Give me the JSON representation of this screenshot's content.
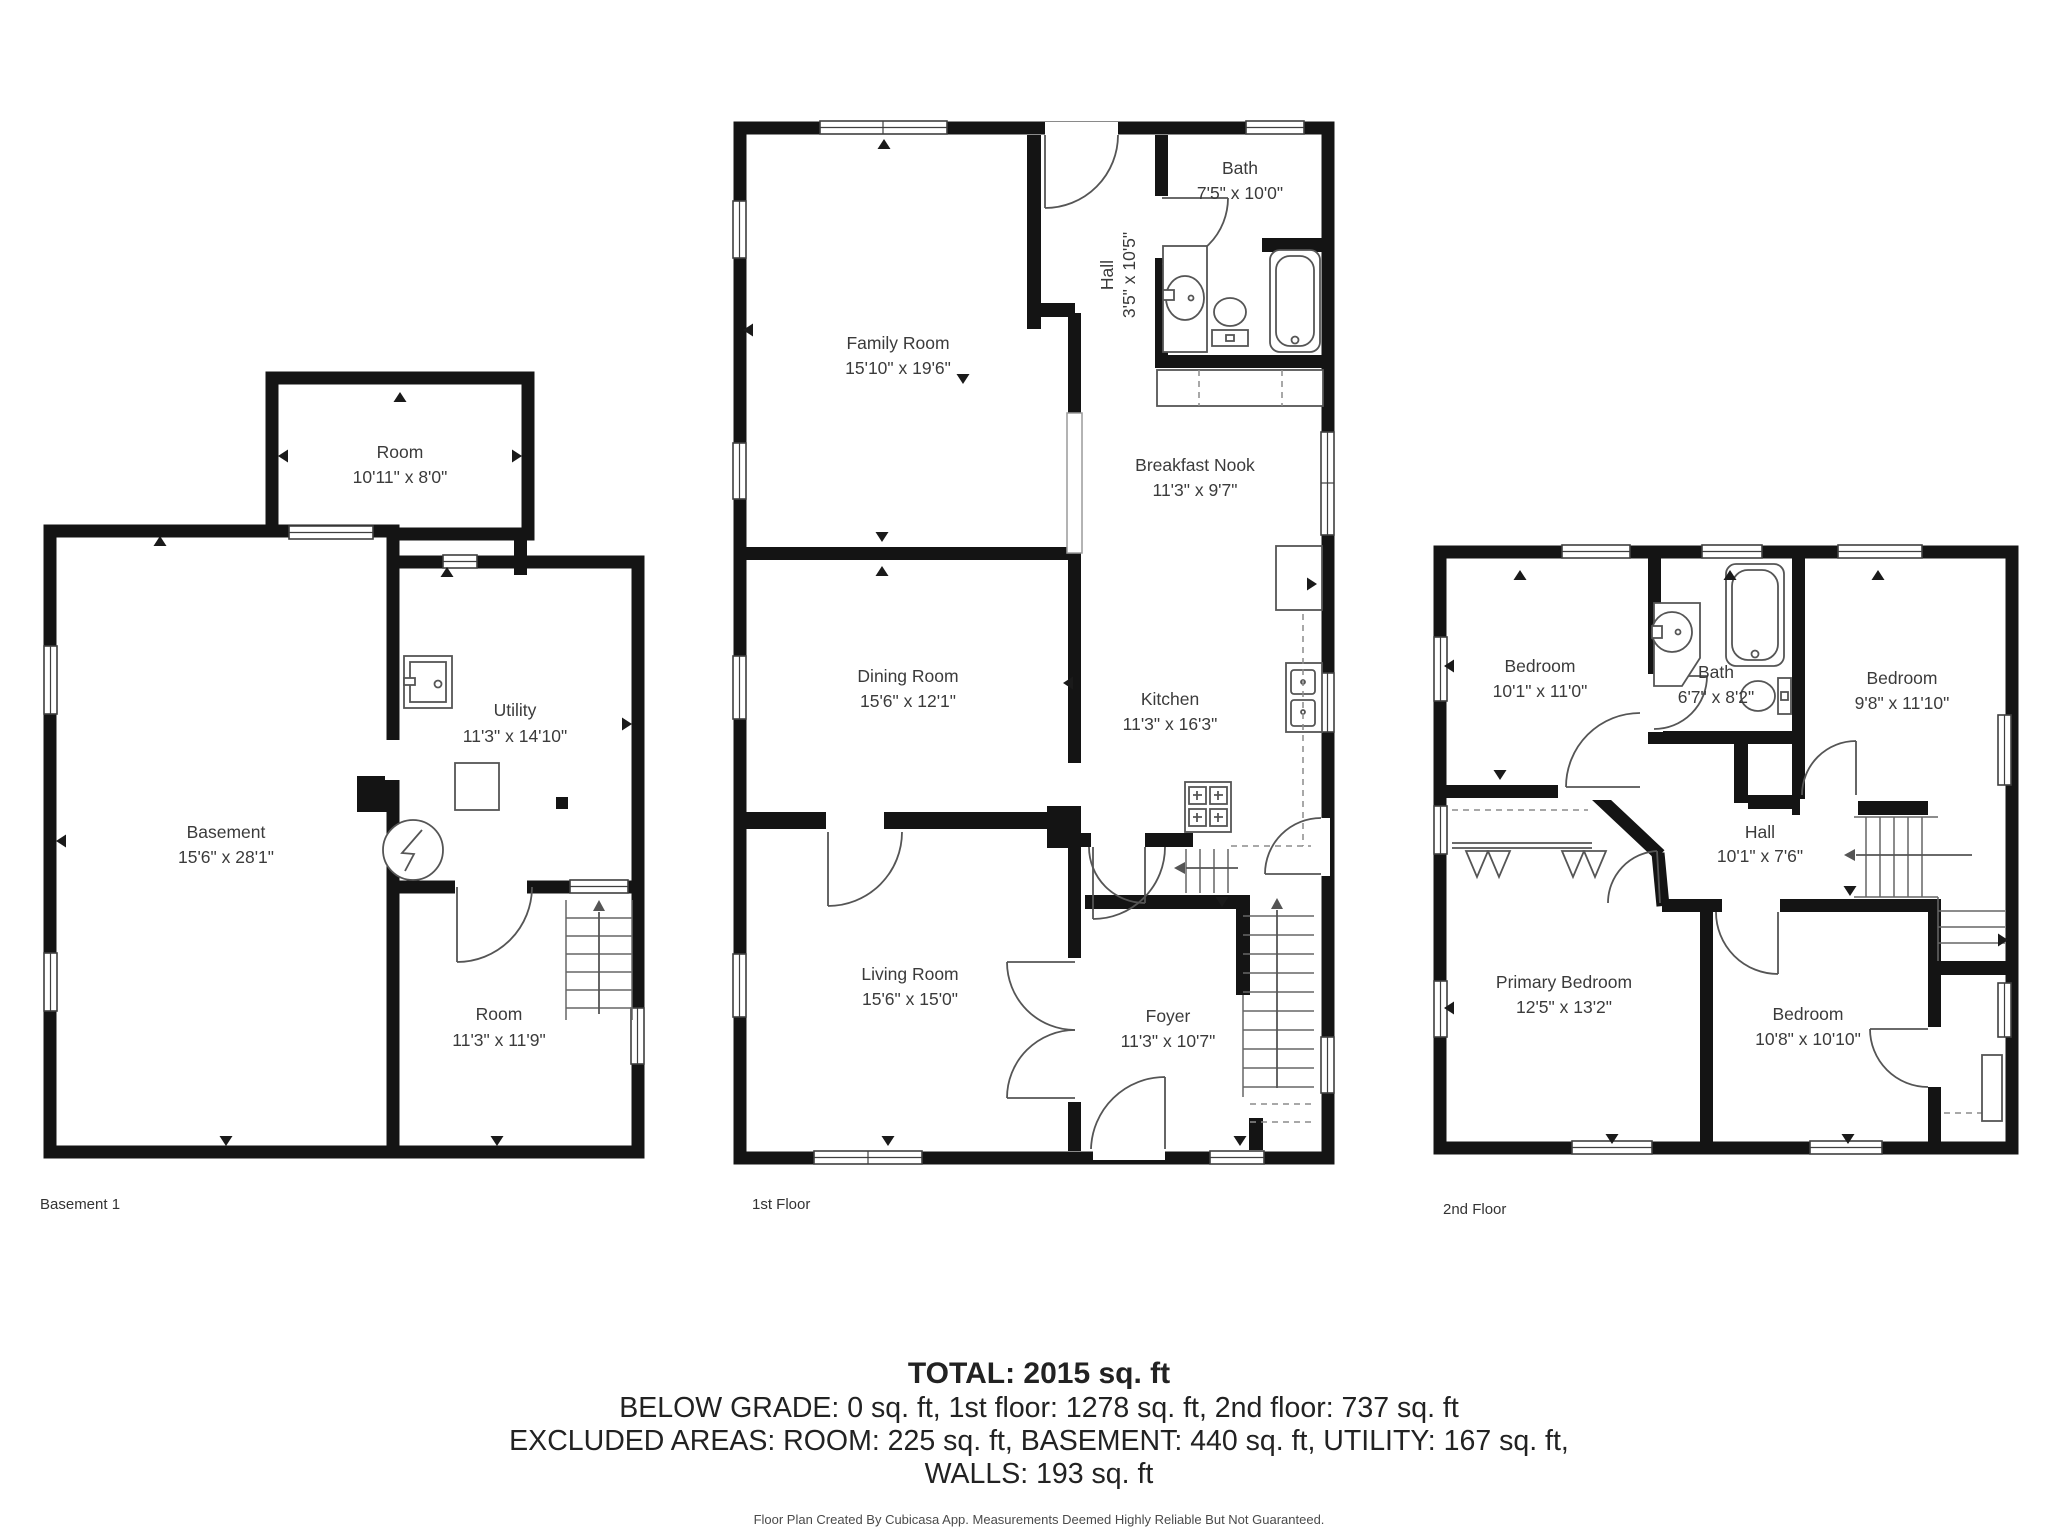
{
  "colors": {
    "wall": "#141414",
    "fixture_line": "#555555",
    "dashed_line": "#8c8c8c",
    "label_text": "#3b3b3b",
    "summary_text": "#222222",
    "background": "#ffffff"
  },
  "floors": [
    {
      "label": "Basement 1",
      "rooms": [
        {
          "name": "Room",
          "dims": "10'11\" x 8'0\""
        },
        {
          "name": "Utility",
          "dims": "11'3\" x 14'10\""
        },
        {
          "name": "Basement",
          "dims": "15'6\" x 28'1\""
        },
        {
          "name": "Room",
          "dims": "11'3\" x 11'9\""
        }
      ]
    },
    {
      "label": "1st Floor",
      "rooms": [
        {
          "name": "Family Room",
          "dims": "15'10\" x 19'6\""
        },
        {
          "name": "Bath",
          "dims": "7'5\" x 10'0\""
        },
        {
          "name": "Hall",
          "dims": "3'5\" x 10'5\""
        },
        {
          "name": "Breakfast Nook",
          "dims": "11'3\" x 9'7\""
        },
        {
          "name": "Dining Room",
          "dims": "15'6\" x 12'1\""
        },
        {
          "name": "Kitchen",
          "dims": "11'3\" x 16'3\""
        },
        {
          "name": "Living Room",
          "dims": "15'6\" x 15'0\""
        },
        {
          "name": "Foyer",
          "dims": "11'3\" x 10'7\""
        }
      ]
    },
    {
      "label": "2nd Floor",
      "rooms": [
        {
          "name": "Bedroom",
          "dims": "10'1\" x 11'0\""
        },
        {
          "name": "Bath",
          "dims": "6'7\" x 8'2\""
        },
        {
          "name": "Bedroom",
          "dims": "9'8\" x 11'10\""
        },
        {
          "name": "Hall",
          "dims": "10'1\" x 7'6\""
        },
        {
          "name": "Primary Bedroom",
          "dims": "12'5\" x 13'2\""
        },
        {
          "name": "Bedroom",
          "dims": "10'8\" x 10'10\""
        }
      ]
    }
  ],
  "summary": {
    "total": "TOTAL: 2015 sq. ft",
    "below_grade_line": "BELOW GRADE: 0 sq. ft, 1st floor: 1278 sq. ft, 2nd floor: 737 sq. ft",
    "excluded_line": "EXCLUDED AREAS: ROOM: 225 sq. ft, BASEMENT: 440 sq. ft, UTILITY: 167 sq. ft,",
    "walls_line": "WALLS: 193 sq. ft",
    "disclaimer": "Floor Plan Created By Cubicasa App. Measurements Deemed Highly Reliable But Not Guaranteed."
  }
}
